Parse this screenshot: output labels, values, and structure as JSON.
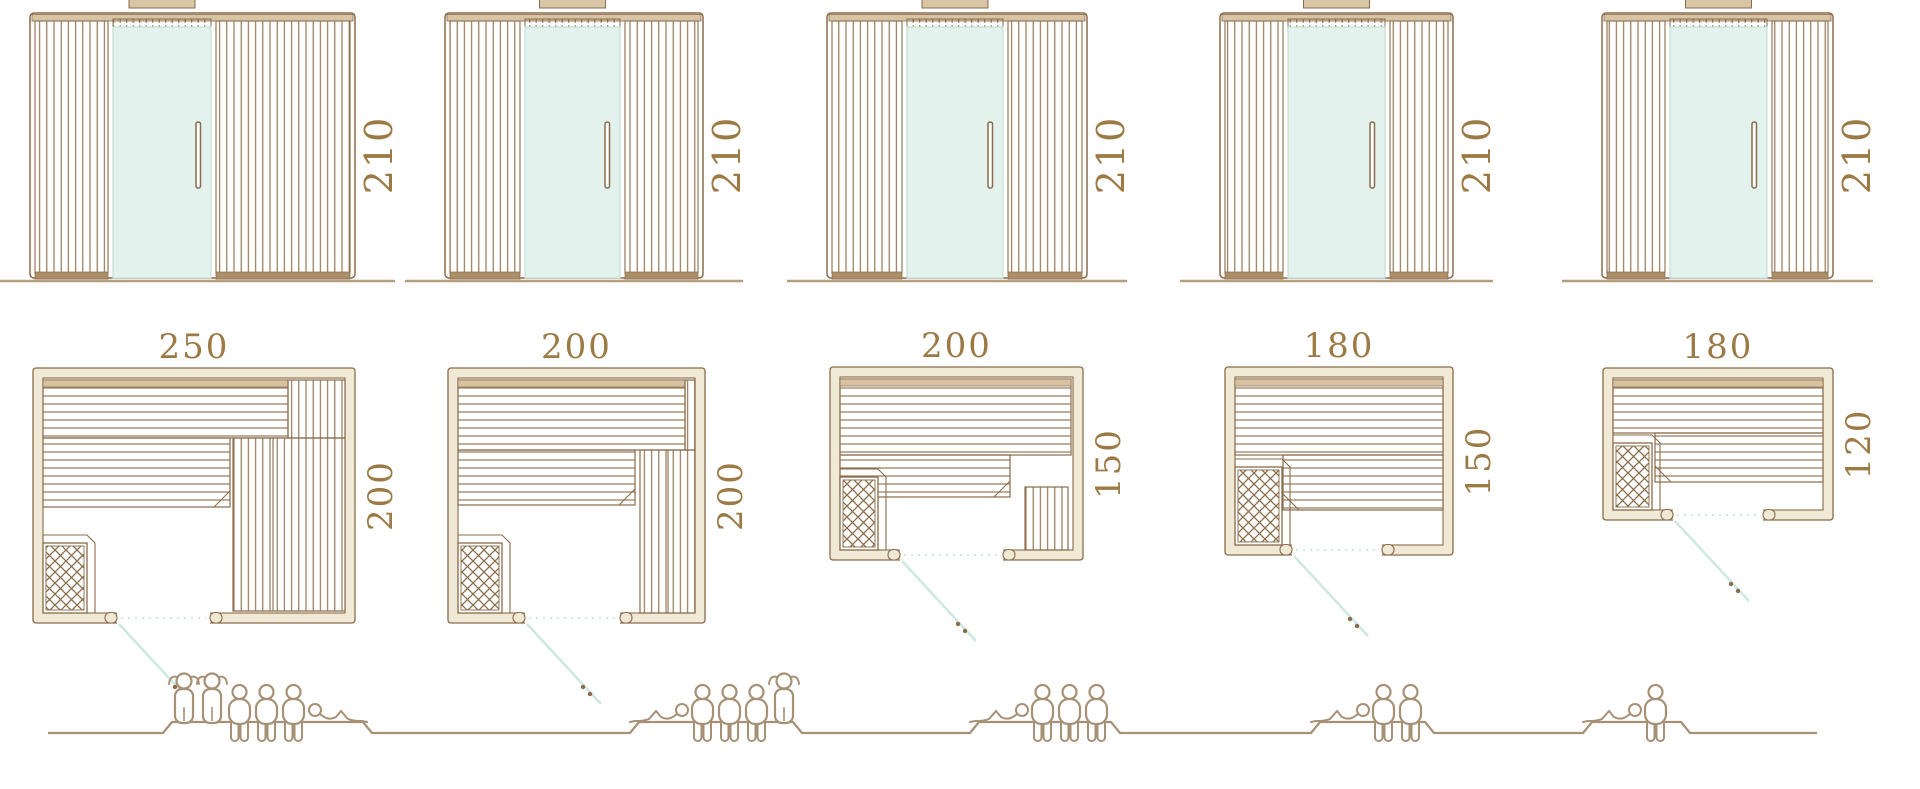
{
  "colors": {
    "line": "#8a6c4a",
    "label": "#9c7a45",
    "wall_fill": "#efe9d5",
    "glass": "#e4f2ee",
    "glass_edge": "#c6ded8",
    "roof": "#d8c5a6",
    "base": "#ab8f69",
    "ground": "#b59e7e",
    "people": "#a69176",
    "door_swing": "#cfe8e2",
    "backrest": "#d6c2a0"
  },
  "saunas": [
    {
      "elevation": {
        "height_label": "210"
      },
      "plan": {
        "width_label": "250",
        "depth_label": "200"
      },
      "figures": [
        "standing",
        "standing",
        "sitting",
        "sitting",
        "sitting",
        "lying"
      ],
      "capacity": {
        "standing": 2,
        "sitting": 3,
        "lying": 1,
        "total": 6
      }
    },
    {
      "elevation": {
        "height_label": "210"
      },
      "plan": {
        "width_label": "200",
        "depth_label": "200"
      },
      "figures": [
        "lying",
        "sitting",
        "sitting",
        "sitting",
        "standing"
      ],
      "capacity": {
        "standing": 1,
        "sitting": 3,
        "lying": 1,
        "total": 5
      }
    },
    {
      "elevation": {
        "height_label": "210"
      },
      "plan": {
        "width_label": "200",
        "depth_label": "150"
      },
      "figures": [
        "lying",
        "sitting",
        "sitting",
        "sitting"
      ],
      "capacity": {
        "standing": 0,
        "sitting": 3,
        "lying": 1,
        "total": 4
      }
    },
    {
      "elevation": {
        "height_label": "210"
      },
      "plan": {
        "width_label": "180",
        "depth_label": "150"
      },
      "figures": [
        "lying",
        "sitting",
        "sitting"
      ],
      "capacity": {
        "standing": 0,
        "sitting": 2,
        "lying": 1,
        "total": 3
      }
    },
    {
      "elevation": {
        "height_label": "210"
      },
      "plan": {
        "width_label": "180",
        "depth_label": "120"
      },
      "figures": [
        "lying",
        "sitting"
      ],
      "capacity": {
        "standing": 0,
        "sitting": 1,
        "lying": 1,
        "total": 2
      }
    }
  ]
}
